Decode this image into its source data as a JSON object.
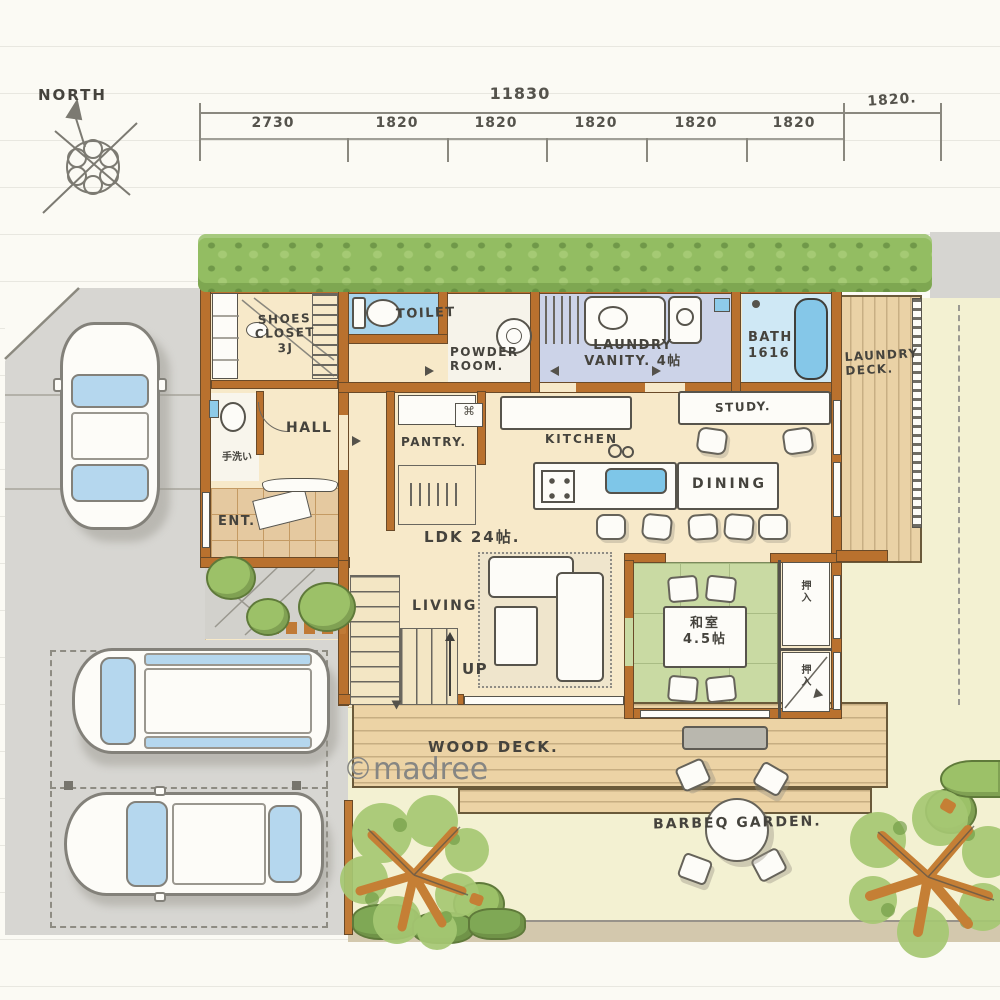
{
  "watermark": "©madree",
  "compass": {
    "label": "NORTH"
  },
  "dimensions": {
    "total": "11830",
    "segments": [
      "2730",
      "1820",
      "1820",
      "1820",
      "1820",
      "1820"
    ],
    "right": "1820."
  },
  "rooms": {
    "shoes_closet": "SHOES\nCLOSET\n3J",
    "toilet": "TOILET",
    "powder_room": "POWDER\nROOM.",
    "laundry_vanity": "LAUNDRY\nVANITY. 4帖",
    "bath": "BATH\n1616",
    "laundry_deck": "LAUNDRY\nDECK.",
    "hall": "HALL",
    "hand_wash": "手洗い",
    "entrance": "ENT.",
    "pantry": "PANTRY.",
    "kitchen": "KITCHEN",
    "study": "STUDY.",
    "dining": "DINING",
    "ldk": "LDK 24帖.",
    "living": "LIVING",
    "stairs_up": "UP",
    "japanese_room": "和室\n4.5帖",
    "closet_upper": "押入",
    "closet_lower": "押入"
  },
  "outdoor": {
    "wood_deck": "WOOD DECK.",
    "bbq_garden": "BARBEQ GARDEN."
  },
  "palette": {
    "wall": "#b9712e",
    "floor": "#f7e9c9",
    "tatami": "#c9daa3",
    "water_blue": "#8ecbe9",
    "laundry_lavender": "#ccd3e8",
    "deck_wood": "#ecd3a5",
    "hedge_green": "#93bd62",
    "road_gray": "#d7d6d2",
    "garden_cream": "#f3f1d2",
    "tree_trunk": "#c57f35",
    "ink": "#45433d"
  }
}
